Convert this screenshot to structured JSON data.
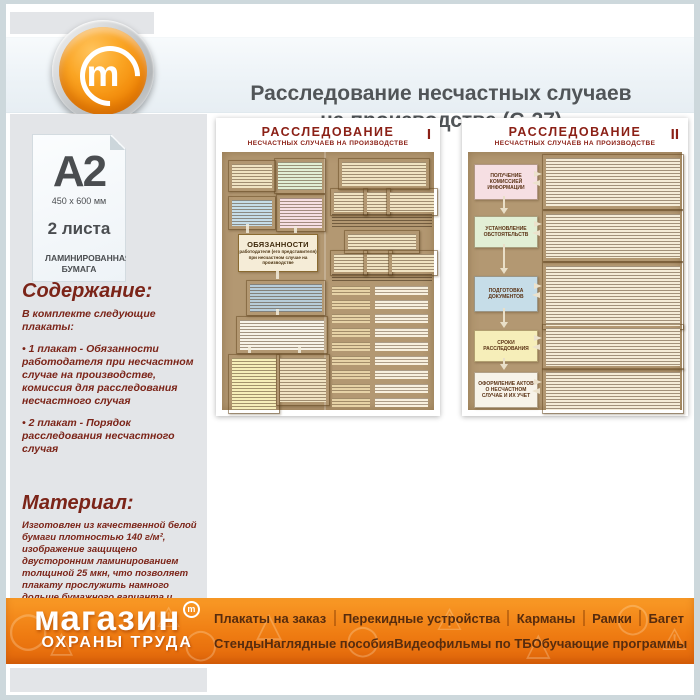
{
  "colors": {
    "accent_orange": "#f07d1a",
    "maroon_text": "#7b2418",
    "poster_title_red": "#8b2016",
    "poster_tan": "#b39872",
    "panel_gray": "#e3e5e8",
    "footer_text_brown": "#572c0e",
    "header_band_blue": "#edf3f7"
  },
  "header": {
    "title_line1": "Расследование несчастных случаев",
    "title_line2": "на производстве (С-27)",
    "logo_letter": "m"
  },
  "sidebar": {
    "format": {
      "size": "A2",
      "dimensions": "450 x 600 мм",
      "sheets": "2 листа",
      "paper": "ЛАМИНИРОВАННАЯ БУМАГА"
    },
    "contents": {
      "heading": "Содержание:",
      "intro": "В комплекте следующие плакаты:",
      "item1": "• 1 плакат - Обязанности работодателя при несчастном случае на производстве, комиссия для расследования несчастного случая",
      "item2": "• 2 плакат - Порядок расследования несчастного случая"
    },
    "material": {
      "heading": "Материал:",
      "text": "Изготовлен из качественной белой бумаги плотностью 140 г/м², изображение защищено двусторонним ламинированием толщиной 25 мкн, что позволяет плакату прослужить намного дольше бумажного варианта и такой плакат не боится влаги - его смело можно протирать."
    }
  },
  "posters": [
    {
      "title": "РАССЛЕДОВАНИЕ",
      "subtitle": "НЕСЧАСТНЫХ СЛУЧАЕВ НА ПРОИЗВОДСТВЕ",
      "numeral": "I",
      "duties_heading": "ОБЯЗАННОСТИ",
      "duties_line1": "работодателя (его представителя)",
      "duties_line2": "при несчастном случае на производстве"
    },
    {
      "title": "РАССЛЕДОВАНИЕ",
      "subtitle": "НЕСЧАСТНЫХ СЛУЧАЕВ НА ПРОИЗВОДСТВЕ",
      "numeral": "II",
      "steps": [
        "ПОЛУЧЕНИЕ КОМИССИЕЙ ИНФОРМАЦИИ",
        "УСТАНОВЛЕНИЕ ОБСТОЯТЕЛЬСТВ",
        "ПОДГОТОВКА ДОКУМЕНТОВ",
        "СРОКИ РАССЛЕДОВАНИЯ",
        "ОФОРМЛЕНИЕ АКТОВ О НЕСЧАСТНОМ СЛУЧАЕ И ИХ УЧЕТ"
      ]
    }
  ],
  "footer": {
    "logo_line1": "магазин",
    "logo_line2": "ОХРАНЫ ТРУДА",
    "logo_badge": "m",
    "menu_row1": [
      "Плакаты на заказ",
      "Перекидные устройства",
      "Карманы",
      "Рамки",
      "Багет"
    ],
    "menu_row2": [
      "Стенды",
      "Наглядные пособия",
      "Видеофильмы по ТБ",
      "Обучающие программы"
    ]
  }
}
